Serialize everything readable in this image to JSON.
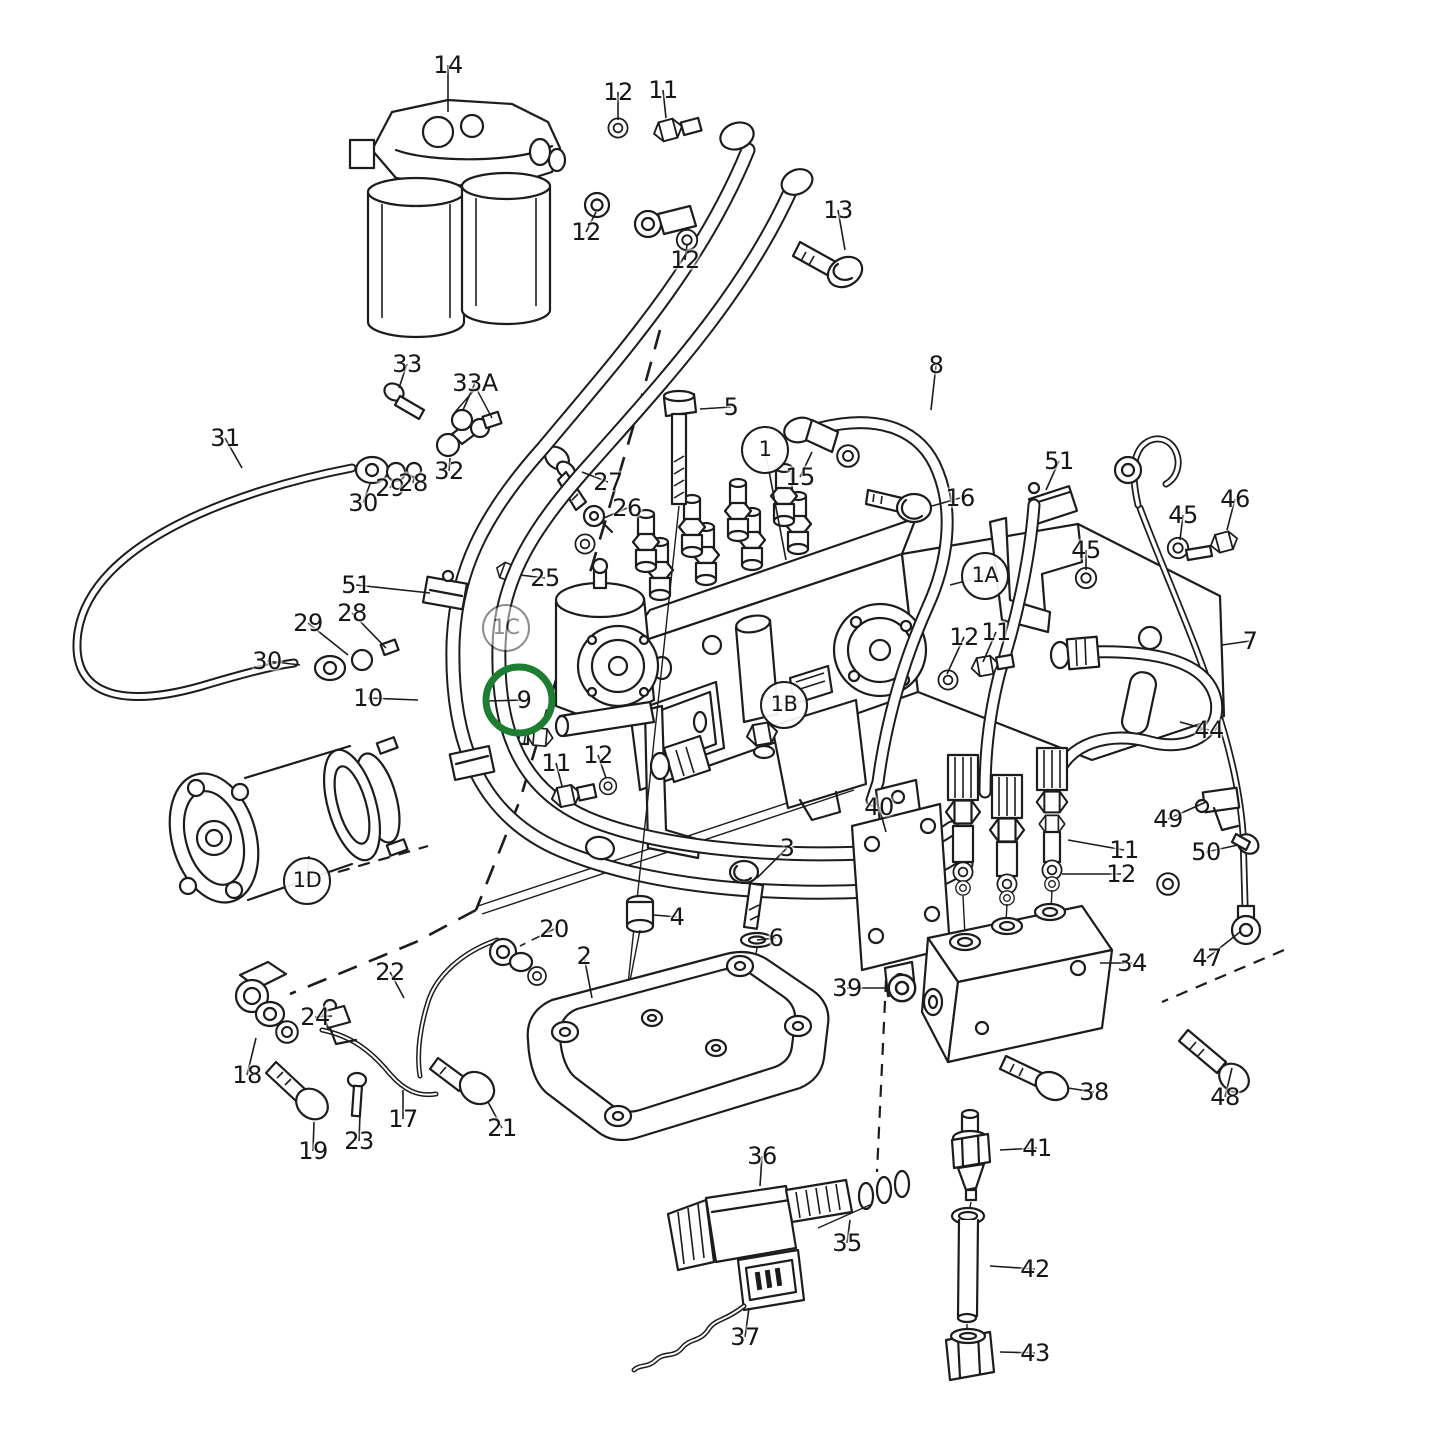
{
  "meta": {
    "background": "#ffffff",
    "line_color": "#1c1c1c",
    "highlight_color": "#1d7d31",
    "highlighted_part": "9",
    "diagram_type": "exploded-parts-diagram"
  },
  "highlight_ring": {
    "x": 519,
    "y": 700,
    "r": 33,
    "stroke_width": 7
  },
  "callouts": [
    {
      "id": "14",
      "text": "14",
      "x": 448,
      "y": 65,
      "circled": false,
      "faint": false,
      "dashed": false,
      "leader": [
        448,
        112
      ],
      "highlighted": false
    },
    {
      "id": "12-1",
      "text": "12",
      "x": 618,
      "y": 92,
      "circled": false,
      "faint": false,
      "dashed": false,
      "leader": [
        618,
        120
      ],
      "highlighted": false
    },
    {
      "id": "11-1",
      "text": "11",
      "x": 663,
      "y": 90,
      "circled": false,
      "faint": false,
      "dashed": false,
      "leader": [
        666,
        118
      ],
      "highlighted": false
    },
    {
      "id": "12-2",
      "text": "12",
      "x": 586,
      "y": 232,
      "circled": false,
      "faint": false,
      "dashed": false,
      "leader": [
        596,
        212
      ],
      "highlighted": false
    },
    {
      "id": "12-3",
      "text": "12",
      "x": 685,
      "y": 260,
      "circled": false,
      "faint": false,
      "dashed": false,
      "leader": [
        687,
        245
      ],
      "highlighted": false
    },
    {
      "id": "13",
      "text": "13",
      "x": 838,
      "y": 210,
      "circled": false,
      "faint": false,
      "dashed": false,
      "leader": [
        845,
        250
      ],
      "highlighted": false
    },
    {
      "id": "33",
      "text": "33",
      "x": 407,
      "y": 364,
      "circled": false,
      "faint": false,
      "dashed": false,
      "leader": [
        399,
        388
      ],
      "highlighted": false
    },
    {
      "id": "33A",
      "text": "33A",
      "x": 475,
      "y": 383,
      "circled": false,
      "faint": false,
      "dashed": false,
      "leader": [
        463,
        410
      ],
      "highlighted": false
    },
    {
      "id": "31",
      "text": "31",
      "x": 225,
      "y": 438,
      "circled": false,
      "faint": false,
      "dashed": false,
      "leader": [
        242,
        468
      ],
      "highlighted": false
    },
    {
      "id": "30-1",
      "text": "30",
      "x": 363,
      "y": 503,
      "circled": false,
      "faint": false,
      "dashed": false,
      "leader": [
        370,
        484
      ],
      "highlighted": false
    },
    {
      "id": "29-1",
      "text": "29",
      "x": 390,
      "y": 488,
      "circled": false,
      "faint": false,
      "dashed": false,
      "leader": [
        394,
        482
      ],
      "highlighted": false
    },
    {
      "id": "28-1",
      "text": "28",
      "x": 413,
      "y": 483,
      "circled": false,
      "faint": false,
      "dashed": false,
      "leader": [
        414,
        478
      ],
      "highlighted": false
    },
    {
      "id": "32",
      "text": "32",
      "x": 449,
      "y": 471,
      "circled": false,
      "faint": false,
      "dashed": false,
      "leader": [
        450,
        458
      ],
      "highlighted": false
    },
    {
      "id": "5",
      "text": "5",
      "x": 731,
      "y": 407,
      "circled": false,
      "faint": false,
      "dashed": false,
      "leader": [
        700,
        409
      ],
      "highlighted": false
    },
    {
      "id": "27",
      "text": "27",
      "x": 608,
      "y": 482,
      "circled": false,
      "faint": false,
      "dashed": false,
      "leader": [
        582,
        472
      ],
      "highlighted": false
    },
    {
      "id": "26",
      "text": "26",
      "x": 627,
      "y": 508,
      "circled": false,
      "faint": false,
      "dashed": false,
      "leader": [
        604,
        518
      ],
      "highlighted": false
    },
    {
      "id": "1",
      "text": "1",
      "x": 765,
      "y": 450,
      "circled": true,
      "faint": false,
      "dashed": false,
      "leader": [
        786,
        560
      ],
      "highlighted": false
    },
    {
      "id": "15",
      "text": "15",
      "x": 800,
      "y": 477,
      "circled": false,
      "faint": false,
      "dashed": false,
      "leader": [
        812,
        452
      ],
      "highlighted": false
    },
    {
      "id": "16",
      "text": "16",
      "x": 960,
      "y": 498,
      "circled": false,
      "faint": false,
      "dashed": false,
      "leader": [
        932,
        506
      ],
      "highlighted": false
    },
    {
      "id": "8",
      "text": "8",
      "x": 936,
      "y": 365,
      "circled": false,
      "faint": false,
      "dashed": false,
      "leader": [
        931,
        410
      ],
      "highlighted": false
    },
    {
      "id": "51-1",
      "text": "51",
      "x": 1059,
      "y": 461,
      "circled": false,
      "faint": false,
      "dashed": false,
      "leader": [
        1046,
        490
      ],
      "highlighted": false
    },
    {
      "id": "45-1",
      "text": "45",
      "x": 1086,
      "y": 550,
      "circled": false,
      "faint": false,
      "dashed": false,
      "leader": [
        1086,
        570
      ],
      "highlighted": false
    },
    {
      "id": "45-2",
      "text": "45",
      "x": 1183,
      "y": 515,
      "circled": false,
      "faint": false,
      "dashed": false,
      "leader": [
        1180,
        540
      ],
      "highlighted": false
    },
    {
      "id": "46",
      "text": "46",
      "x": 1235,
      "y": 499,
      "circled": false,
      "faint": false,
      "dashed": false,
      "leader": [
        1227,
        530
      ],
      "highlighted": false
    },
    {
      "id": "1A",
      "text": "1A",
      "x": 985,
      "y": 576,
      "circled": true,
      "faint": false,
      "dashed": false,
      "leader": [
        950,
        585
      ],
      "highlighted": false
    },
    {
      "id": "7",
      "text": "7",
      "x": 1250,
      "y": 641,
      "circled": false,
      "faint": false,
      "dashed": false,
      "leader": [
        1222,
        645
      ],
      "highlighted": false
    },
    {
      "id": "44",
      "text": "44",
      "x": 1209,
      "y": 730,
      "circled": false,
      "faint": false,
      "dashed": false,
      "leader": [
        1180,
        722
      ],
      "highlighted": false
    },
    {
      "id": "12-4",
      "text": "12",
      "x": 964,
      "y": 637,
      "circled": false,
      "faint": false,
      "dashed": false,
      "leader": [
        947,
        674
      ],
      "highlighted": false
    },
    {
      "id": "11-4",
      "text": "11",
      "x": 996,
      "y": 632,
      "circled": false,
      "faint": false,
      "dashed": false,
      "leader": [
        983,
        662
      ],
      "highlighted": false
    },
    {
      "id": "25",
      "text": "25",
      "x": 545,
      "y": 578,
      "circled": false,
      "faint": false,
      "dashed": false,
      "leader": [
        520,
        575
      ],
      "highlighted": false
    },
    {
      "id": "51-2",
      "text": "51",
      "x": 356,
      "y": 585,
      "circled": false,
      "faint": false,
      "dashed": false,
      "leader": [
        430,
        593
      ],
      "highlighted": false
    },
    {
      "id": "28-2",
      "text": "28",
      "x": 352,
      "y": 613,
      "circled": false,
      "faint": false,
      "dashed": false,
      "leader": [
        386,
        648
      ],
      "highlighted": false
    },
    {
      "id": "29-2",
      "text": "29",
      "x": 308,
      "y": 623,
      "circled": false,
      "faint": false,
      "dashed": false,
      "leader": [
        348,
        655
      ],
      "highlighted": false
    },
    {
      "id": "30-2",
      "text": "30",
      "x": 267,
      "y": 661,
      "circled": false,
      "faint": false,
      "dashed": false,
      "leader": [
        300,
        665
      ],
      "highlighted": false
    },
    {
      "id": "1C",
      "text": "1C",
      "x": 506,
      "y": 628,
      "circled": true,
      "faint": true,
      "dashed": false,
      "leader": null,
      "highlighted": false
    },
    {
      "id": "10",
      "text": "10",
      "x": 368,
      "y": 698,
      "circled": false,
      "faint": false,
      "dashed": false,
      "leader": [
        418,
        700
      ],
      "highlighted": false
    },
    {
      "id": "9",
      "text": "9",
      "x": 524,
      "y": 700,
      "circled": false,
      "faint": false,
      "dashed": false,
      "leader": [
        487,
        701
      ],
      "highlighted": true
    },
    {
      "id": "11-2",
      "text": "11",
      "x": 556,
      "y": 763,
      "circled": false,
      "faint": false,
      "dashed": false,
      "leader": [
        562,
        786
      ],
      "highlighted": false
    },
    {
      "id": "12-5",
      "text": "12",
      "x": 598,
      "y": 755,
      "circled": false,
      "faint": false,
      "dashed": false,
      "leader": [
        606,
        778
      ],
      "highlighted": false
    },
    {
      "id": "1B",
      "text": "1B",
      "x": 784,
      "y": 705,
      "circled": true,
      "faint": false,
      "dashed": false,
      "leader": [
        762,
        695
      ],
      "highlighted": false
    },
    {
      "id": "1D",
      "text": "1D",
      "x": 307,
      "y": 881,
      "circled": true,
      "faint": false,
      "dashed": false,
      "leader": [
        309,
        856
      ],
      "highlighted": false
    },
    {
      "id": "40",
      "text": "40",
      "x": 879,
      "y": 807,
      "circled": false,
      "faint": false,
      "dashed": false,
      "leader": [
        886,
        832
      ],
      "highlighted": false
    },
    {
      "id": "3",
      "text": "3",
      "x": 787,
      "y": 848,
      "circled": false,
      "faint": false,
      "dashed": false,
      "leader": [
        757,
        878
      ],
      "highlighted": false
    },
    {
      "id": "20",
      "text": "20",
      "x": 554,
      "y": 929,
      "circled": false,
      "faint": false,
      "dashed": true,
      "leader": [
        520,
        946
      ],
      "highlighted": false
    },
    {
      "id": "22",
      "text": "22",
      "x": 390,
      "y": 972,
      "circled": false,
      "faint": false,
      "dashed": false,
      "leader": [
        404,
        998
      ],
      "highlighted": false
    },
    {
      "id": "24",
      "text": "24",
      "x": 315,
      "y": 1017,
      "circled": false,
      "faint": false,
      "dashed": false,
      "leader": [
        332,
        1016
      ],
      "highlighted": false
    },
    {
      "id": "18",
      "text": "18",
      "x": 247,
      "y": 1075,
      "circled": false,
      "faint": false,
      "dashed": false,
      "leader": [
        256,
        1038
      ],
      "highlighted": false
    },
    {
      "id": "19",
      "text": "19",
      "x": 313,
      "y": 1151,
      "circled": false,
      "faint": false,
      "dashed": false,
      "leader": [
        314,
        1122
      ],
      "highlighted": false
    },
    {
      "id": "23",
      "text": "23",
      "x": 359,
      "y": 1141,
      "circled": false,
      "faint": false,
      "dashed": false,
      "leader": [
        360,
        1114
      ],
      "highlighted": false
    },
    {
      "id": "17",
      "text": "17",
      "x": 403,
      "y": 1119,
      "circled": false,
      "faint": false,
      "dashed": false,
      "leader": [
        403,
        1090
      ],
      "highlighted": false
    },
    {
      "id": "21",
      "text": "21",
      "x": 502,
      "y": 1128,
      "circled": false,
      "faint": false,
      "dashed": false,
      "leader": [
        488,
        1102
      ],
      "highlighted": false
    },
    {
      "id": "2",
      "text": "2",
      "x": 584,
      "y": 956,
      "circled": false,
      "faint": false,
      "dashed": false,
      "leader": [
        592,
        998
      ],
      "highlighted": false
    },
    {
      "id": "4",
      "text": "4",
      "x": 677,
      "y": 917,
      "circled": false,
      "faint": false,
      "dashed": false,
      "leader": [
        654,
        915
      ],
      "highlighted": false
    },
    {
      "id": "6",
      "text": "6",
      "x": 776,
      "y": 938,
      "circled": false,
      "faint": false,
      "dashed": false,
      "leader": [
        757,
        940
      ],
      "highlighted": false
    },
    {
      "id": "39",
      "text": "39",
      "x": 847,
      "y": 988,
      "circled": false,
      "faint": false,
      "dashed": false,
      "leader": [
        886,
        988
      ],
      "highlighted": false
    },
    {
      "id": "49",
      "text": "49",
      "x": 1168,
      "y": 819,
      "circled": false,
      "faint": false,
      "dashed": false,
      "leader": [
        1206,
        802
      ],
      "highlighted": false
    },
    {
      "id": "50",
      "text": "50",
      "x": 1206,
      "y": 852,
      "circled": false,
      "faint": false,
      "dashed": false,
      "leader": [
        1238,
        845
      ],
      "highlighted": false
    },
    {
      "id": "11-3",
      "text": "11",
      "x": 1124,
      "y": 850,
      "circled": false,
      "faint": false,
      "dashed": false,
      "leader": [
        1068,
        840
      ],
      "highlighted": false
    },
    {
      "id": "12-6",
      "text": "12",
      "x": 1121,
      "y": 874,
      "circled": false,
      "faint": false,
      "dashed": false,
      "leader": [
        1062,
        874
      ],
      "highlighted": false
    },
    {
      "id": "34",
      "text": "34",
      "x": 1132,
      "y": 963,
      "circled": false,
      "faint": false,
      "dashed": false,
      "leader": [
        1100,
        963
      ],
      "highlighted": false
    },
    {
      "id": "47",
      "text": "47",
      "x": 1207,
      "y": 958,
      "circled": false,
      "faint": false,
      "dashed": false,
      "leader": [
        1240,
        932
      ],
      "highlighted": false
    },
    {
      "id": "48",
      "text": "48",
      "x": 1225,
      "y": 1097,
      "circled": false,
      "faint": false,
      "dashed": false,
      "leader": [
        1232,
        1068
      ],
      "highlighted": false
    },
    {
      "id": "38",
      "text": "38",
      "x": 1094,
      "y": 1092,
      "circled": false,
      "faint": false,
      "dashed": false,
      "leader": [
        1068,
        1088
      ],
      "highlighted": false
    },
    {
      "id": "41",
      "text": "41",
      "x": 1037,
      "y": 1148,
      "circled": false,
      "faint": false,
      "dashed": false,
      "leader": [
        1000,
        1150
      ],
      "highlighted": false
    },
    {
      "id": "42",
      "text": "42",
      "x": 1035,
      "y": 1269,
      "circled": false,
      "faint": false,
      "dashed": false,
      "leader": [
        990,
        1266
      ],
      "highlighted": false
    },
    {
      "id": "43",
      "text": "43",
      "x": 1035,
      "y": 1353,
      "circled": false,
      "faint": false,
      "dashed": false,
      "leader": [
        1000,
        1352
      ],
      "highlighted": false
    },
    {
      "id": "36",
      "text": "36",
      "x": 762,
      "y": 1156,
      "circled": false,
      "faint": false,
      "dashed": false,
      "leader": [
        760,
        1186
      ],
      "highlighted": false
    },
    {
      "id": "35",
      "text": "35",
      "x": 847,
      "y": 1243,
      "circled": false,
      "faint": false,
      "dashed": false,
      "leader": [
        850,
        1220
      ],
      "highlighted": false
    },
    {
      "id": "37",
      "text": "37",
      "x": 745,
      "y": 1337,
      "circled": false,
      "faint": false,
      "dashed": false,
      "leader": [
        749,
        1308
      ],
      "highlighted": false
    }
  ]
}
